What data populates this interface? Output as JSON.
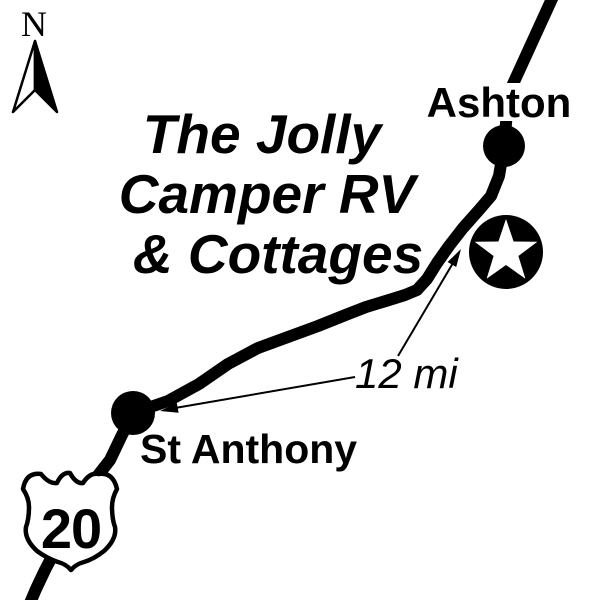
{
  "canvas": {
    "background": "#ffffff",
    "ink": "#000000"
  },
  "compass": {
    "label": "N"
  },
  "title": {
    "lines": [
      "The Jolly",
      "Camper RV",
      "& Cottages"
    ]
  },
  "towns": {
    "ashton": "Ashton",
    "st_anthony": "St Anthony"
  },
  "route_shield": {
    "number": "20"
  },
  "distance": {
    "label": "12 mi"
  }
}
